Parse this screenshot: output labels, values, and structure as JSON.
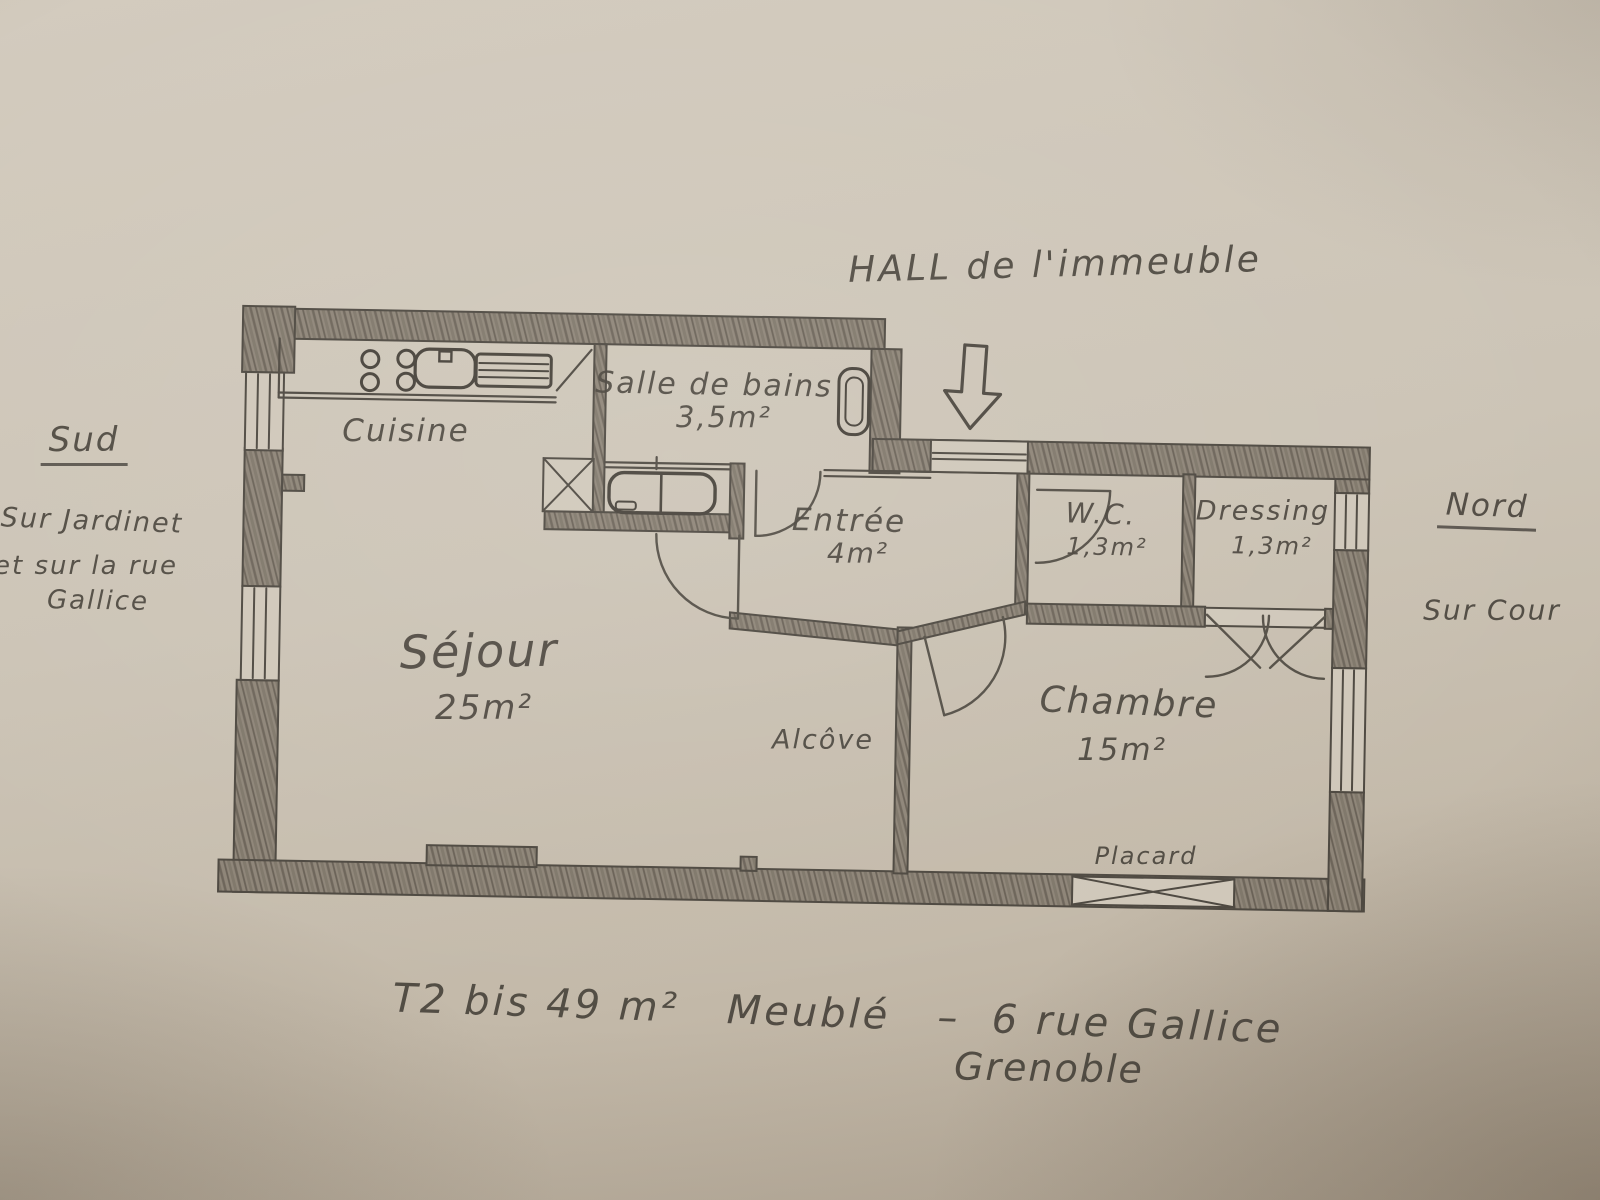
{
  "palette": {
    "paper": "#cdc5b7",
    "pencil": "#4e4941",
    "wall_fill": "#8e8578"
  },
  "annotations": {
    "hall": "HALL de l'immeuble",
    "south": {
      "title": "Sud",
      "lines": [
        "Sur Jardinet",
        "et sur la rue",
        "Gallice"
      ]
    },
    "north": {
      "title": "Nord",
      "lines": [
        "Sur Cour"
      ]
    },
    "caption_line1": "T2 bis 49 m²   Meublé   –  6 rue Gallice",
    "caption_line2": "Grenoble"
  },
  "rooms": {
    "cuisine": {
      "name": "Cuisine"
    },
    "salle_de_bains": {
      "name": "Salle de bains",
      "area": "3,5m²"
    },
    "entree": {
      "name": "Entrée",
      "area": "4m²"
    },
    "wc": {
      "name": "W.C.",
      "area": "1,3m²"
    },
    "dressing": {
      "name": "Dressing",
      "area": "1,3m²"
    },
    "sejour": {
      "name": "Séjour",
      "area": "25m²"
    },
    "alcove": {
      "name": "Alcôve"
    },
    "chambre": {
      "name": "Chambre",
      "area": "15m²"
    },
    "placard": {
      "name": "Placard"
    }
  }
}
